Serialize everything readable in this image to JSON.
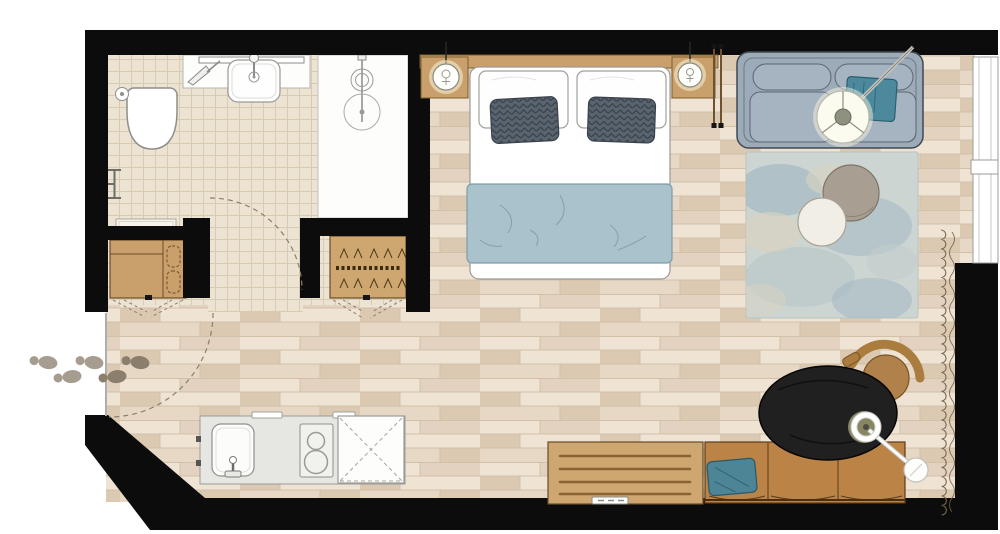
{
  "plan": {
    "kind": "hotel-studio-floor-plan",
    "rooms": [
      "bathroom",
      "entry-hall",
      "sleeping-living-area",
      "kitchenette-corner"
    ],
    "items": [
      "toilet",
      "vanity-sink",
      "mirror",
      "shower",
      "towel-rail",
      "bath-mat",
      "minibar-cabinet",
      "wardrobe-with-hangers",
      "entry-door-swing",
      "bathroom-door-swing",
      "footprints",
      "double-bed",
      "pillows",
      "accent-pillows",
      "duvet",
      "headboard",
      "nightstand-left",
      "nightstand-right",
      "pendant-lamp-left",
      "pendant-lamp-right",
      "luggage-rack",
      "sofa",
      "throw-blanket",
      "arc-floor-lamp",
      "area-rug",
      "round-table-gray",
      "round-table-white",
      "window-band",
      "curtain",
      "kitchen-counter",
      "kitchen-sink",
      "cooktop",
      "appliance-void",
      "sideboard",
      "banquette-bench",
      "bench-pillow",
      "oval-table",
      "wood-chair",
      "pendant-lamp-table"
    ]
  },
  "colors": {
    "wall": "#0c0c0c",
    "floor_base": "#e7d8c6",
    "plank_light": "#efe4d4",
    "plank_mid": "#e2d2bf",
    "plank_dark": "#dbc9b2",
    "plank_line": "#d2c0a8",
    "tile_base": "#ece3d2",
    "tile_line": "#d7cbb4",
    "fixture_white": "#fdfdfc",
    "outline_gray": "#9a9a96",
    "wood_light": "#c9a06b",
    "wood_mid": "#cda670",
    "wood_line": "#6a4b26",
    "duvet_blue": "#a9c2cb",
    "duvet_line": "#7e9da9",
    "pillow_dark": "#5a646f",
    "pillow_dark_line": "#38404a",
    "sofa_gray": "#9dabb9",
    "sofa_cushion": "#a6b3c0",
    "sofa_outline": "#3e4954",
    "throw_teal": "#4d899c",
    "throw_line": "#2a5f70",
    "rug_base": "#ccd5d2",
    "rug_blue": "#9db6c2",
    "rug_sand": "#d8d2bf",
    "table_taupe": "#a89e92",
    "table_white": "#f1eee5",
    "bench_leather": "#bb8446",
    "bench_line": "#5c3b18",
    "pillow_teal": "#4e8596",
    "table_black": "#202020",
    "chair_wood": "#b0814a",
    "curtain_brown": "#7a684e",
    "dash_brown": "#8d7f6a",
    "footprint_out": "#a69d90",
    "footprint_in": "#8c7e6d",
    "lamp_glow": "#fffbe2",
    "glow_yellow": "#efe9a6"
  }
}
